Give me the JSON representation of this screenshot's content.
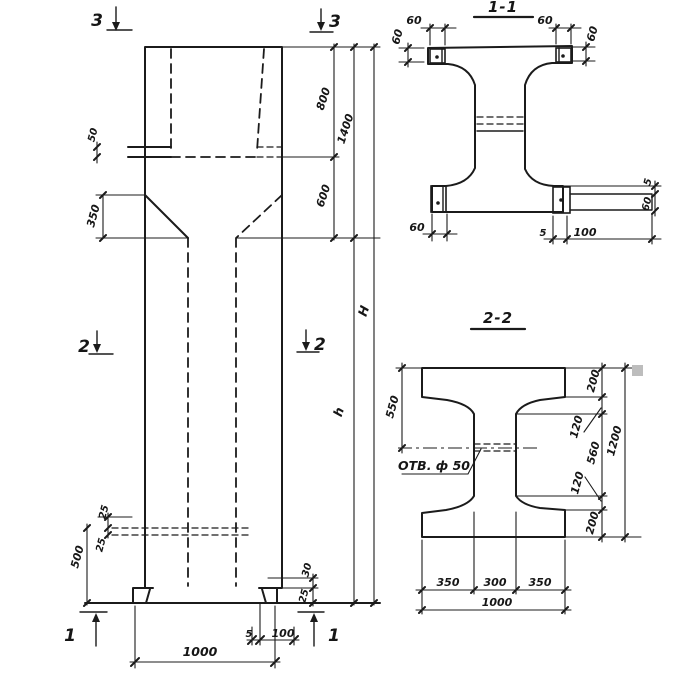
{
  "drawing": {
    "ink_color": "#1b1b1b",
    "background": "#ffffff",
    "elevation": {
      "marks": {
        "m3_left": "3",
        "m3_right": "3",
        "m2_left": "2",
        "m2_right": "2",
        "m1_left": "1",
        "m1_right": "1"
      },
      "dims": {
        "ledge_50": "50",
        "taper_350": "350",
        "socket_800": "800",
        "neck_600": "600",
        "head_1400": "1400",
        "shaft_h": "h",
        "total_H": "H",
        "slot_25_upper": "25",
        "slot_25_lower": "25",
        "bottom_500": "500",
        "base_1000": "1000",
        "foot_5": "5",
        "foot_100": "100",
        "foot_30": "30",
        "foot_25": "25"
      }
    },
    "section_1_1": {
      "title": "1-1",
      "dims": {
        "top_left_w_60": "60",
        "top_left_h_60": "60",
        "top_right_w_60": "60",
        "top_right_h_60": "60",
        "bottom_left_60": "60",
        "bottom_5": "5",
        "bottom_100": "100",
        "right_5": "5",
        "right_60": "60"
      }
    },
    "section_2_2": {
      "title": "2-2",
      "hole_label": "ОТВ. ф 50",
      "dims": {
        "left_550": "550",
        "right_200_top": "200",
        "right_120_top": "120",
        "right_560": "560",
        "right_120_bottom": "120",
        "right_200_bottom": "200",
        "right_1200": "1200",
        "bottom_350_left": "350",
        "bottom_300": "300",
        "bottom_350_right": "350",
        "bottom_1000": "1000"
      }
    }
  }
}
